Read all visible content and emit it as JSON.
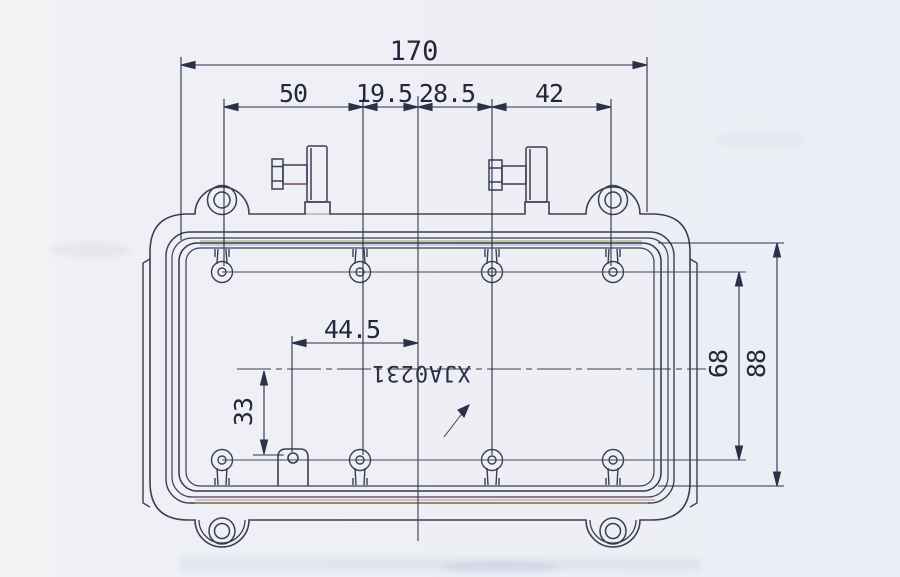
{
  "drawing": {
    "part_number": "XJA0231",
    "dimensions": {
      "total_width": "170",
      "top_spacing_1": "50",
      "top_spacing_2": "19.5",
      "top_spacing_3": "28.5",
      "top_spacing_4": "42",
      "boss_offset_x": "44.5",
      "boss_offset_y": "33",
      "hole_row_spacing": "68",
      "opening_height": "88"
    },
    "colors": {
      "line_main": "#3d3d55",
      "line_dim": "#2e2f4a",
      "paper": "#edeff5",
      "fringe_green": "#6f9c3f",
      "fringe_purple": "#8a62a8",
      "fringe_red": "#b5604a",
      "fringe_yellow": "#c9a84c"
    }
  }
}
